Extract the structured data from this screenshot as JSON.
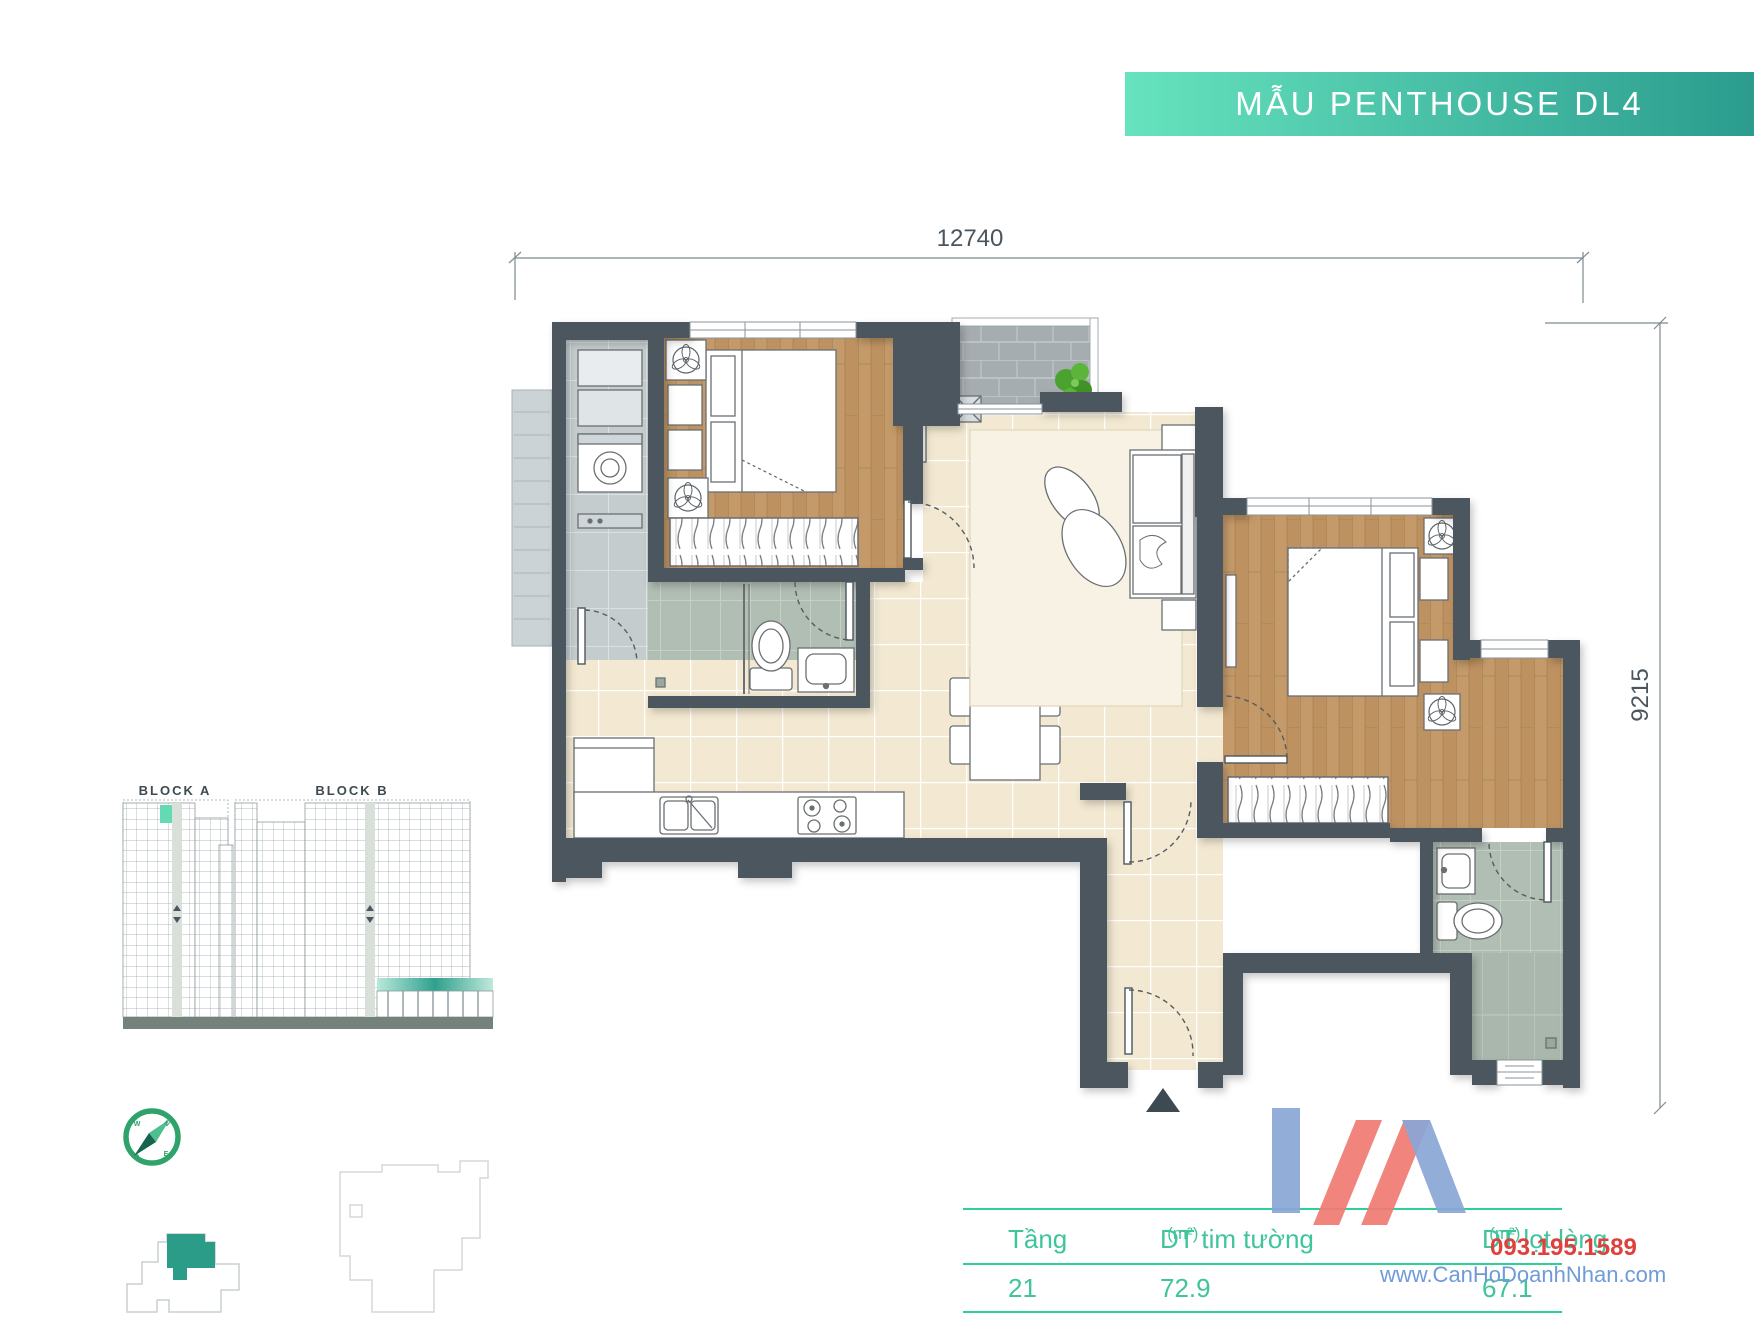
{
  "banner": {
    "title": "MẪU PENTHOUSE DL4",
    "gradient_from": "#66e3be",
    "gradient_to": "#2b9c8e"
  },
  "dimensions": {
    "top": "12740",
    "right": "9215"
  },
  "site": {
    "block_a_label": "BLOCK A",
    "block_b_label": "BLOCK B"
  },
  "table": {
    "col_floor": "Tầng",
    "col_wall_area": "DT tim tường",
    "col_wall_area_unit": "(m²)",
    "col_net_area": "DT lọt lòng",
    "col_net_area_unit": "(m²)",
    "row": {
      "floor": "21",
      "wall_area": "72.9",
      "net_area": "67.1"
    },
    "accent_color": "#3fc49b",
    "line_color": "#2fcf96"
  },
  "watermark": {
    "phone": "093.195.1589",
    "website": "www.CanHoDoanhNhan.com",
    "phone_color": "#e0403c",
    "website_color": "#6f9bd8"
  },
  "plan": {
    "wall_color": "#4b565f",
    "wood_color": "#c49a6a",
    "tile_color": "#f3e9d2",
    "bath_color": "#b1beb4",
    "balcony_color": "#a6adb1",
    "highlight_color": "#2a9c88",
    "compass_color": "#2fa36b"
  }
}
